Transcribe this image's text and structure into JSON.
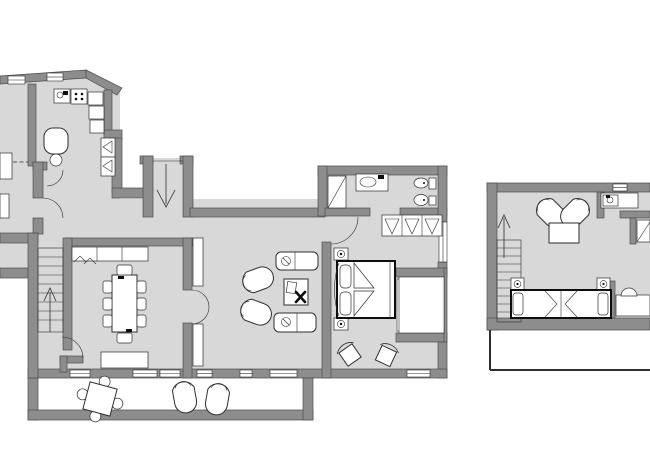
{
  "meta": {
    "type": "architectural-floor-plan",
    "views": 2,
    "units": "none-shown",
    "labels_visible": false
  },
  "colors": {
    "background": "#ffffff",
    "wall": "#8d8d8d",
    "wall_outline": "#4e4e4e",
    "floor": "#d8d8d8",
    "furniture_fill": "#ffffff",
    "furniture_stroke": "#2e2e2e",
    "window_fill": "#ffffff",
    "accent_black": "#0d0d0d"
  },
  "plans": [
    {
      "id": "main-floor",
      "position": "left",
      "rooms": [
        "kitchen",
        "hallway",
        "entry",
        "dining-room",
        "living-room",
        "bedroom",
        "bathroom",
        "terrace",
        "balcony",
        "staircase",
        "partial-side-rooms"
      ],
      "furniture": [
        "kitchen-sink",
        "stove",
        "kitchen-cabinets",
        "kitchen-table-with-chair",
        "hall-wardrobe",
        "entry-direction-arrow",
        "staircase-down",
        "dining-table-eight-chairs",
        "sideboard-top",
        "sideboard-bottom",
        "shell-armchair",
        "shell-armchair",
        "desk-with-chair",
        "lounge-seat",
        "lounge-seat",
        "double-bed",
        "nightstand-lamp",
        "nightstand-lamp",
        "hanging-closet",
        "shower",
        "washbasin",
        "toilet",
        "bidet",
        "bedroom-chair",
        "bedroom-chair",
        "terrace-table-four-chairs",
        "terrace-chair",
        "terrace-chair"
      ]
    },
    {
      "id": "upper-floor",
      "position": "right",
      "rooms": [
        "studio-room",
        "bathroom",
        "staircase",
        "roof-terrace"
      ],
      "furniture": [
        "staircase-up-arrow",
        "shell-armchair",
        "shell-armchair",
        "side-table",
        "washbasin",
        "corner-fixture",
        "twin-bed",
        "twin-bed",
        "nightstand-lamp",
        "nightstand-lamp",
        "desk",
        "desk-item"
      ]
    }
  ]
}
